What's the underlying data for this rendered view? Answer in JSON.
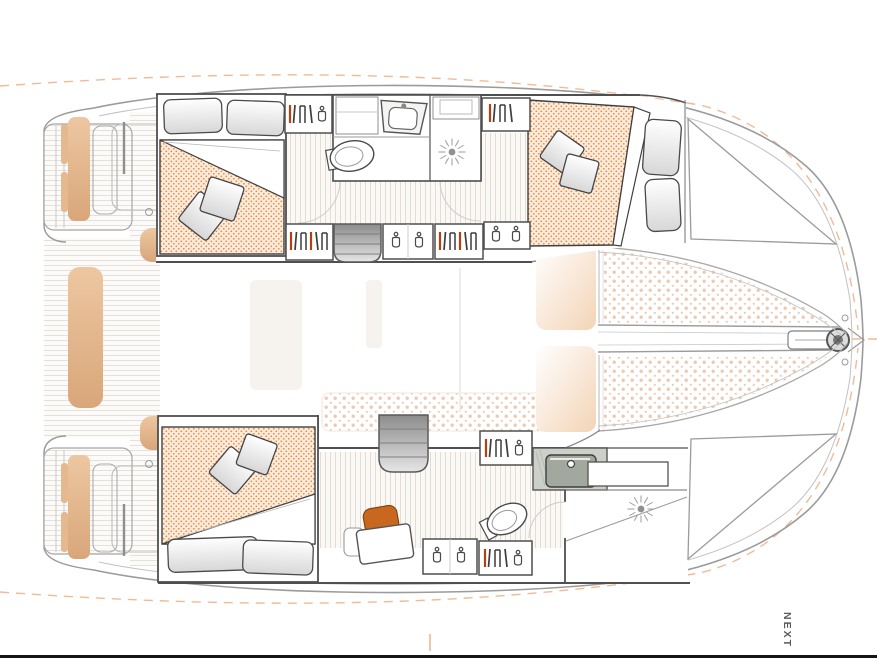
{
  "footer": {
    "next_label": "NEXT"
  },
  "colors": {
    "hull-line": "#9b9b9b",
    "toe-line": "#c2c2c2",
    "wall": "#4f4f4f",
    "furniture-line": "#3f3f3f",
    "matt-bg": "#fceadb",
    "matt-dot": "#e0873c",
    "tramp-dot": "#eccab2",
    "teak-line": "#e4e0da",
    "teak-bg": "#fcfbf9",
    "strip-line": "#e2dcd4",
    "strip-bg": "#fbf9f6",
    "tan": "#e5b88f",
    "tan-dark": "#d9a67a",
    "chair": "#c8681f",
    "chair-line": "#8a4311",
    "red-cloth": "#b5400f",
    "icon-line": "#4a4a4a",
    "ghost": "#f6f3ef",
    "seat-peach": "#f3d4b6",
    "dash-orange": "#f0b28c",
    "bar": "#161616",
    "next": "#5a5a5a",
    "steps-dark": "#8c8c8c",
    "steps-light": "#e6e6e6",
    "counter": "#ccd0c9",
    "basin": "#a3a89e"
  },
  "icons": {
    "coat-hanger": "open-top U loop with hook ring",
    "hanging-clothes": "group of vertical strokes (two orange)",
    "shower-drain": "starburst rays around center dot",
    "windlass": "concentric circles at bow",
    "anchor-roller": "rounded rectangle on longeron"
  }
}
